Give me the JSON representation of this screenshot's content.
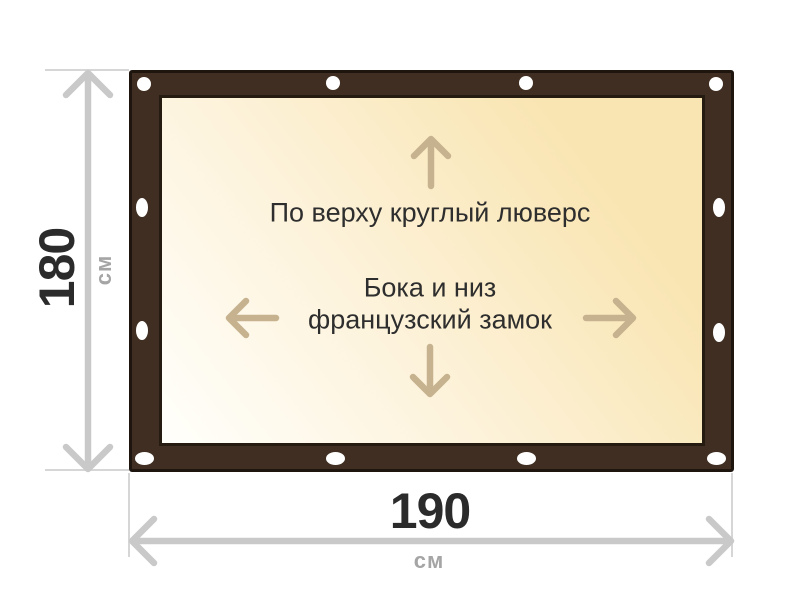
{
  "dimensions": {
    "height": {
      "value": "180",
      "unit": "см"
    },
    "width": {
      "value": "190",
      "unit": "см"
    }
  },
  "annotations": {
    "top_edge": "По верху круглый люверс",
    "sides_bottom_line1": "Бока и низ",
    "sides_bottom_line2": "французский замок"
  },
  "icons": {
    "grommet": "grommet-icon",
    "arrow_up": "arrow-up-icon",
    "arrow_down": "arrow-down-icon",
    "arrow_left": "arrow-left-icon",
    "arrow_right": "arrow-right-icon",
    "dimension_arrow_vertical": "dimension-arrow-vertical",
    "dimension_arrow_horizontal": "dimension-arrow-horizontal"
  },
  "grommet_count": 12,
  "colors": {
    "frame_brown": "#3F2E21",
    "frame_outline": "#1E150E",
    "panel_border": "#261B11",
    "panel_gradient_light": "#FFFFFB",
    "panel_gradient_cream": "#F9E5B2",
    "direction_arrow": "#C6B28E",
    "dimension_arrow": "#C9C9C9",
    "extension_line": "#D6D6D6",
    "value_text": "#2B2B2B",
    "unit_text": "#A5A5A5",
    "label_text": "#2E2E2E",
    "grommet_fill": "#FFFFFF",
    "background": "#FFFFFF"
  }
}
